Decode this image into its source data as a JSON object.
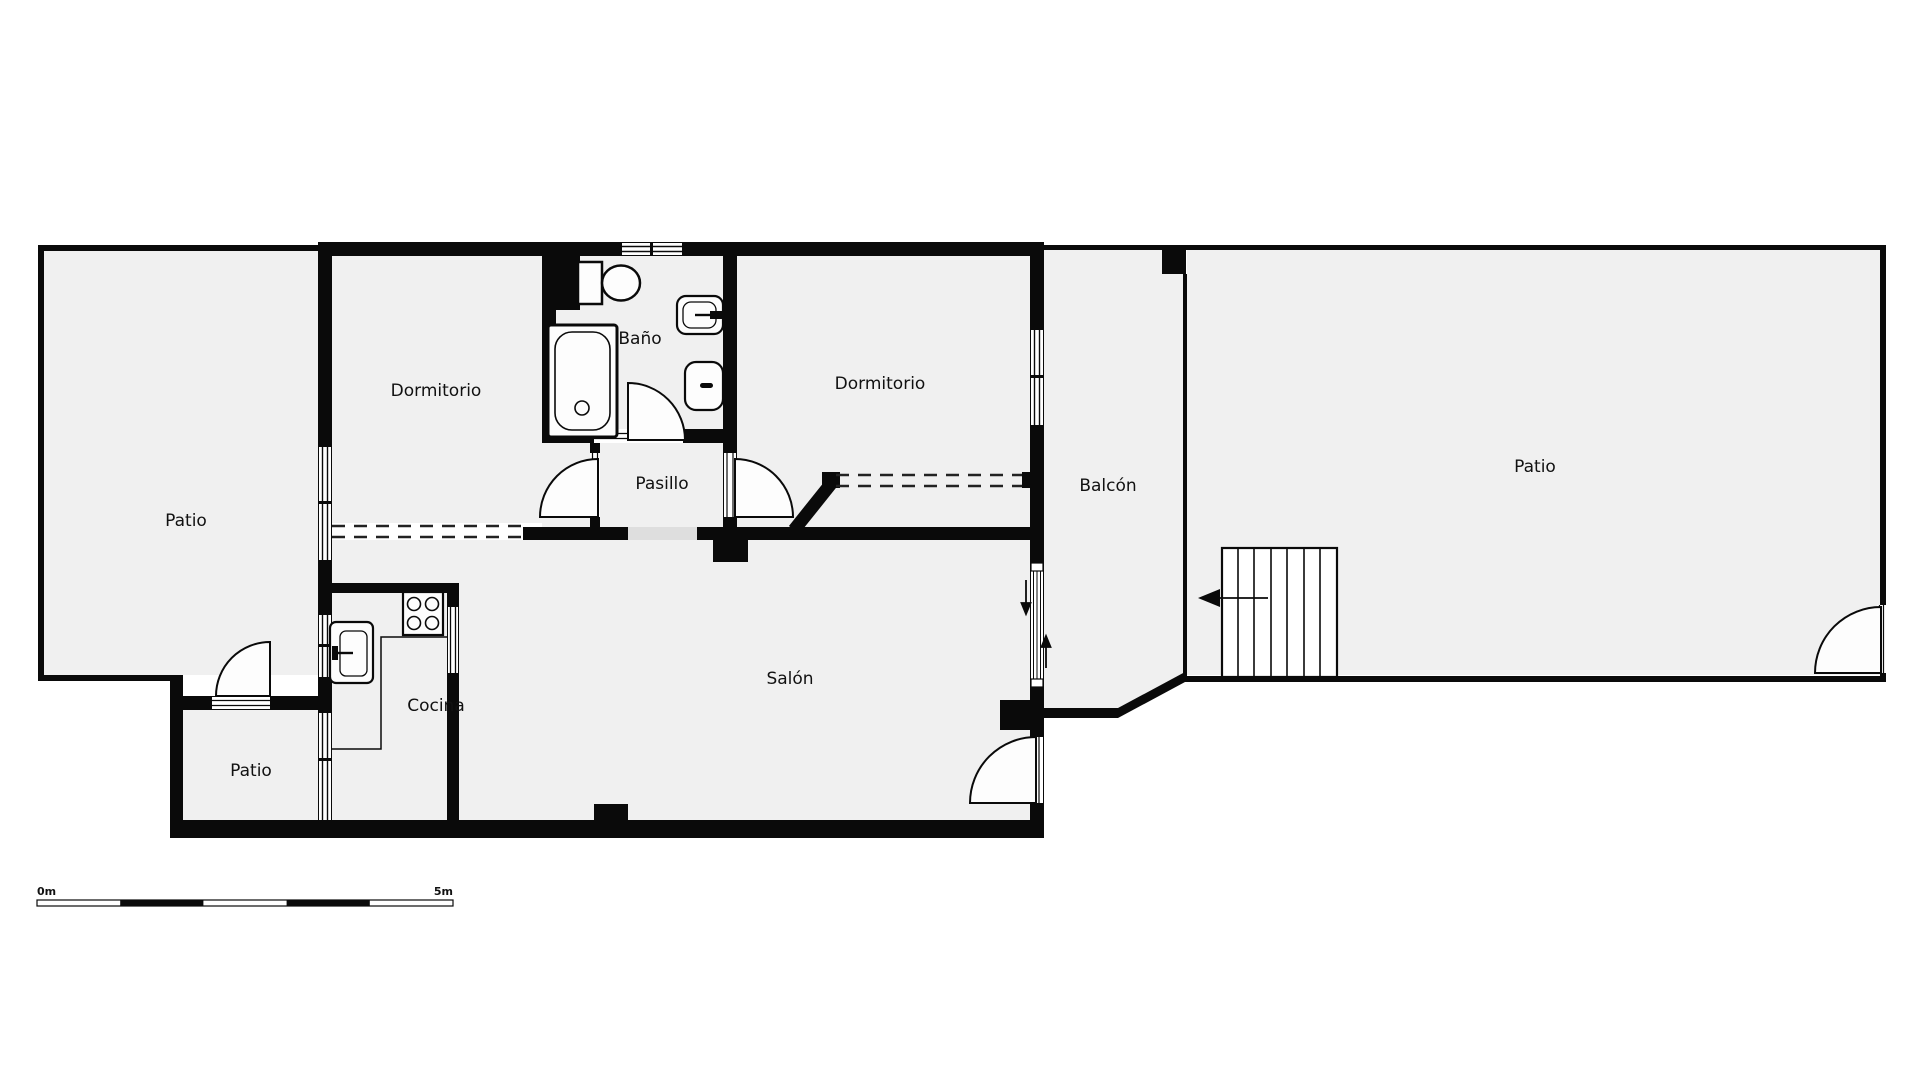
{
  "title": "Floor plan",
  "rooms": {
    "patio_left": {
      "label": "Patio"
    },
    "patio_small": {
      "label": "Patio"
    },
    "dormitorio_1": {
      "label": "Dormitorio"
    },
    "bano": {
      "label": "Baño"
    },
    "pasillo": {
      "label": "Pasillo"
    },
    "dormitorio_2": {
      "label": "Dormitorio"
    },
    "cocina": {
      "label": "Cocina"
    },
    "salon": {
      "label": "Salón"
    },
    "balcon": {
      "label": "Balcón"
    },
    "patio_right": {
      "label": "Patio"
    }
  },
  "scale_bar": {
    "start_label": "0m",
    "end_label": "5m"
  },
  "fixtures": [
    "toilet",
    "bathtub",
    "washbasin",
    "bidet",
    "stove",
    "kitchen-sink",
    "counter",
    "stairs"
  ],
  "colors": {
    "wall": "#0a0a0a",
    "floor": "#f0f0f0",
    "background": "#ffffff",
    "fixture_fill": "#fdfdfd",
    "threshold": "#dedede"
  }
}
